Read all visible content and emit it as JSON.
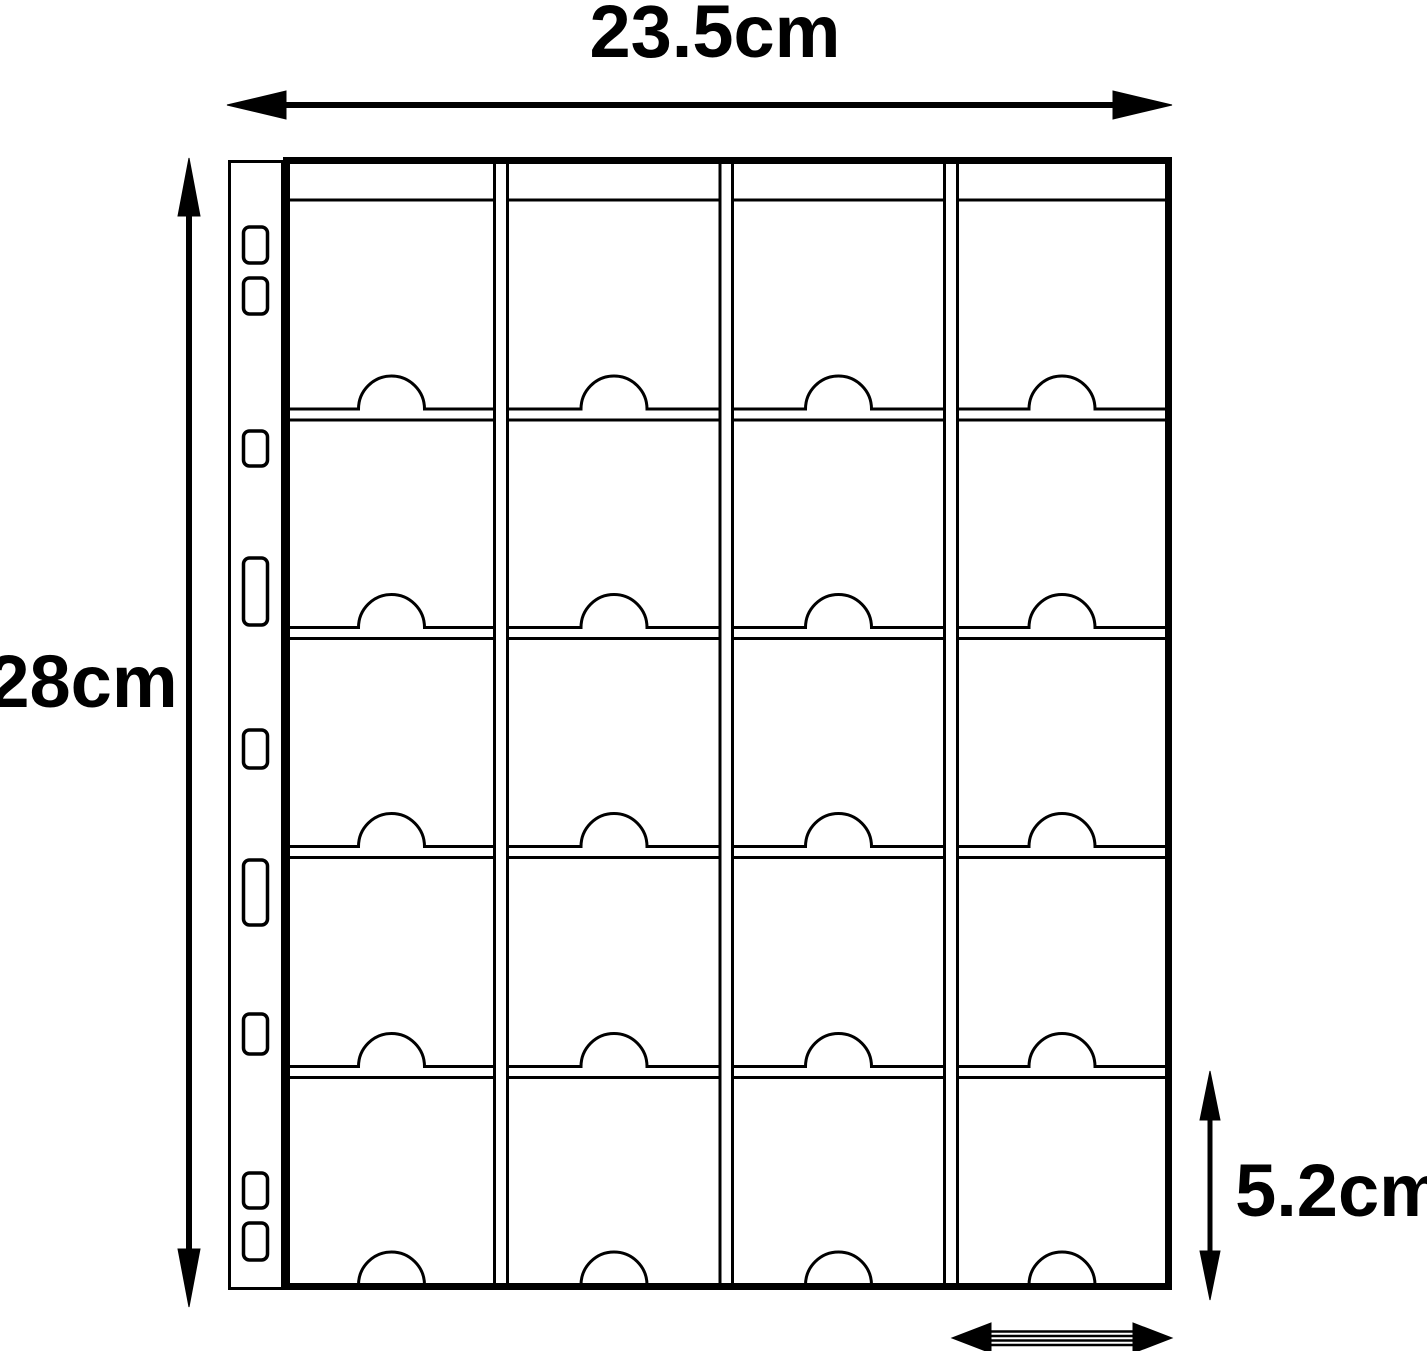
{
  "diagram": {
    "type": "product-dimension-diagram",
    "subject": "20-pocket binder page with thumb-notch pockets and punched binding holes",
    "dimensions": {
      "page_width_label": "23.5cm",
      "page_height_label": "28cm",
      "pocket_height_label": "5.2cm"
    },
    "grid": {
      "columns": 4,
      "rows": 5,
      "pockets": 20
    },
    "binder_holes_count": 9,
    "colors": {
      "line": "#000000",
      "background": "#ffffff"
    }
  }
}
